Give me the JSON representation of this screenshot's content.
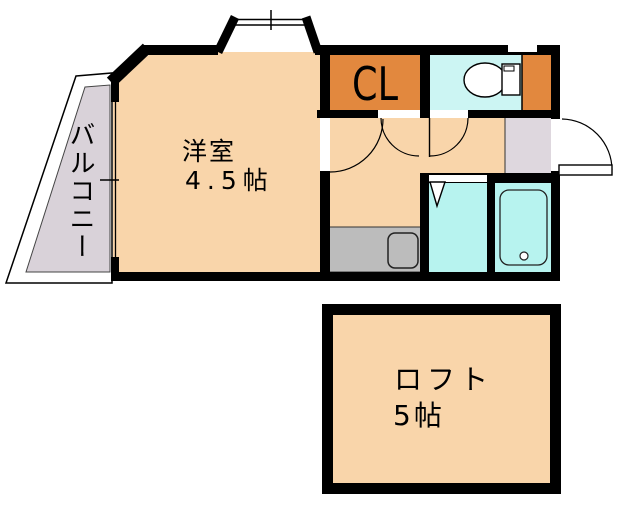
{
  "rooms": {
    "balcony": {
      "label": "バルコニー"
    },
    "main": {
      "label": "洋室",
      "size": "4.5帖"
    },
    "closet": {
      "label": "CL"
    },
    "loft": {
      "label": "ロフト",
      "size": "5帖"
    }
  },
  "colors": {
    "wall": "#000000",
    "room_fill": "#f9d5aa",
    "closet_fill": "#e2883e",
    "toilet_fill": "#ccf5f3",
    "bath_fill": "#b7f3ef",
    "kitchen_fill": "#bcbcbc",
    "entry_fill": "#ded7de",
    "balcony_fill": "#d9d2d9",
    "fixture_fill": "#ffffff",
    "text": "#000000"
  }
}
